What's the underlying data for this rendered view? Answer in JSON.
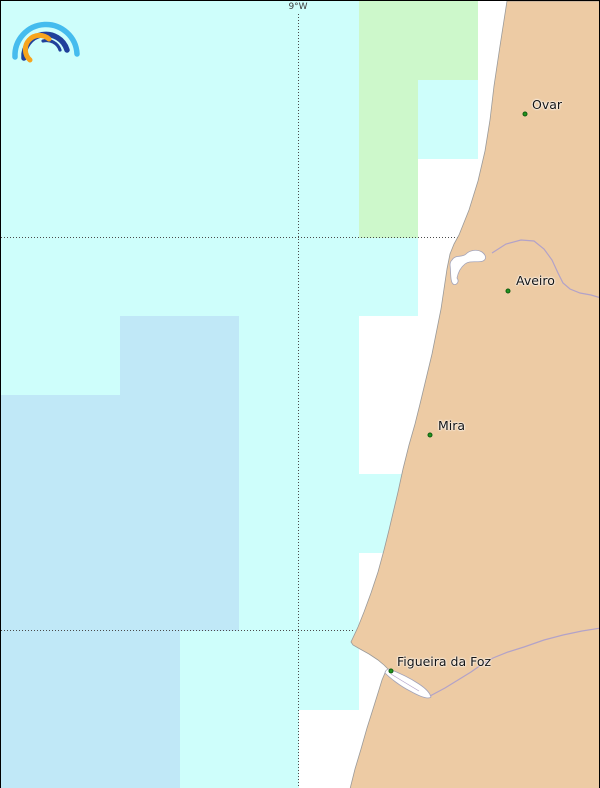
{
  "map": {
    "title_note": "coastal weather-grid map, Portugal (Ovar / Aveiro / Mira / Figueira da Foz)",
    "colors": {
      "cell_cyan": "#cefefb",
      "cell_blue": "#c0e8f7",
      "cell_green": "#cdf8cb",
      "sea_nodata": "#ffffff",
      "land": "#edcba4",
      "river": "#b2a2c8",
      "city_dot": "#22941e",
      "grid_dots": "#4a4a4a"
    },
    "grid": {
      "col_edges": [
        0,
        59.5,
        119,
        178.5,
        238,
        297.5,
        357.5,
        417,
        477,
        536.5,
        600
      ],
      "row_edges": [
        0,
        78.5,
        157.5,
        236.5,
        315,
        394,
        473,
        551.5,
        630,
        708.5,
        788
      ],
      "legend": {
        "c": "light-cyan cell",
        "b": "light-blue cell",
        "g": "light-green cell",
        "w": "no data (white)"
      },
      "matrix": [
        "ccccccggww",
        "ccccccgcww",
        "ccccccgwww",
        "cccccccwww",
        "ccbbccwwww",
        "bbbbccwwww",
        "bbbbcccwww",
        "bbbbccwwww",
        "bbbcccwwww",
        "bbbccwwwww"
      ]
    },
    "gridlines": {
      "vertical": {
        "x": 297,
        "y_top": 13,
        "label": "9°W"
      },
      "horizontal": [
        {
          "y": 236,
          "x_start": 0,
          "x_end": 457
        },
        {
          "y": 629,
          "x_start": 0,
          "x_end": 353
        }
      ]
    },
    "shapes": {
      "land_path": "M506,0 L600,0 L600,788 L349,788 L354,768 L360,748 L366,727 L372,708 L377,692 L381,679 L384,672 L387,668 L383,664 L377,659 L368,653 L359,648 L352,644 L350,641 L357,626 L363,611 L370,592 L377,571 L383,549 L388,529 L392,512 L397,491 L402,468 L408,444 L414,423 L419,403 L425,378 L431,353 L436,328 L440,308 L443,288 L446,268 L449,253 L453,243 L458,234 L468,209 L477,180 L484,150 L489,119 L493,85 L499,45 Z",
      "lagoon_path": "M451,259 C455,253 461,257 465,253 C469,249 476,248 481,251 C485,254 486,258 482,260 C476,262 469,259 464,263 C459,267 457,272 456,277 C459,281 455,285 452,283 C449,280 450,271 449,264 C449,261 450,260 451,259 Z",
      "estuary_path": "M388,668 C396,671 409,677 418,683 C424,687 429,692 430,696 C427,699 418,695 409,690 C399,685 389,677 384,672 C384,670 386,668 388,668 Z",
      "estuary_channel": "M390,673 C398,678 408,684 418,690",
      "river_vouga": "M491,252 L505,243 L520,239 L533,240 L543,248 L551,259 L557,272 L562,282 L569,288 L579,292 L590,294 L600,297",
      "river_mondego": "M429,695 L444,687 L457,679 L470,671 L480,664 L492,657 L507,651 L523,646 L543,639 L562,634 L581,630 L600,627"
    },
    "cities": [
      {
        "name": "Ovar",
        "dot_x": 524,
        "dot_y": 113,
        "label_x": 531,
        "label_y": 96
      },
      {
        "name": "Aveiro",
        "dot_x": 507,
        "dot_y": 290,
        "label_x": 515,
        "label_y": 272
      },
      {
        "name": "Mira",
        "dot_x": 429,
        "dot_y": 434,
        "label_x": 437,
        "label_y": 417
      },
      {
        "name": "Figueira da Foz",
        "dot_x": 390,
        "dot_y": 670,
        "label_x": 396,
        "label_y": 653
      }
    ]
  },
  "logo": {
    "name": "rainbow-weather-logo",
    "arc_outer_color": "#45bcee",
    "arc_middle_color": "#20409a",
    "arc_inner_color": "#20409a",
    "arc_orange_color": "#f7a41d"
  }
}
